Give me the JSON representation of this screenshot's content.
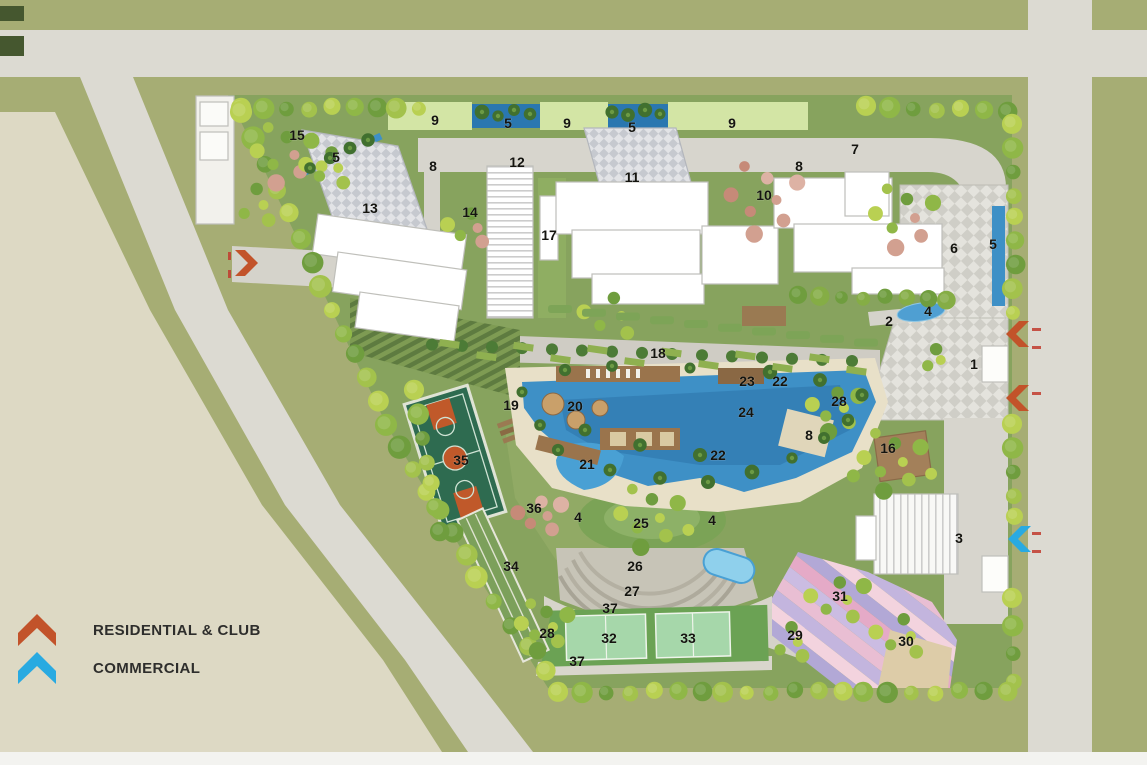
{
  "legend": {
    "items": [
      {
        "id": "residential",
        "label": "RESIDENTIAL & CLUB",
        "color": "#c2532a"
      },
      {
        "id": "commercial",
        "label": "COMMERCIAL",
        "color": "#29aae1"
      }
    ]
  },
  "colors": {
    "residential": "#c2532a",
    "commercial": "#29aae1",
    "pool_water": "#3e90c6",
    "site_lawn": "#87a35e",
    "road": "#dcdad2",
    "verge": "#a6ad74",
    "open_parcel": "#ddd9c4"
  },
  "markers": [
    {
      "n": "1",
      "x": 974,
      "y": 364
    },
    {
      "n": "2",
      "x": 889,
      "y": 321
    },
    {
      "n": "3",
      "x": 959,
      "y": 538
    },
    {
      "n": "4",
      "x": 928,
      "y": 311
    },
    {
      "n": "4",
      "x": 578,
      "y": 517
    },
    {
      "n": "4",
      "x": 712,
      "y": 520
    },
    {
      "n": "5",
      "x": 336,
      "y": 157
    },
    {
      "n": "5",
      "x": 508,
      "y": 123
    },
    {
      "n": "5",
      "x": 632,
      "y": 127
    },
    {
      "n": "5",
      "x": 993,
      "y": 244
    },
    {
      "n": "6",
      "x": 954,
      "y": 248
    },
    {
      "n": "7",
      "x": 855,
      "y": 149
    },
    {
      "n": "8",
      "x": 433,
      "y": 166
    },
    {
      "n": "8",
      "x": 799,
      "y": 166
    },
    {
      "n": "8",
      "x": 809,
      "y": 435
    },
    {
      "n": "9",
      "x": 435,
      "y": 120
    },
    {
      "n": "9",
      "x": 567,
      "y": 123
    },
    {
      "n": "9",
      "x": 732,
      "y": 123
    },
    {
      "n": "10",
      "x": 764,
      "y": 195
    },
    {
      "n": "11",
      "x": 632,
      "y": 177
    },
    {
      "n": "12",
      "x": 517,
      "y": 162
    },
    {
      "n": "13",
      "x": 370,
      "y": 208
    },
    {
      "n": "14",
      "x": 470,
      "y": 212
    },
    {
      "n": "15",
      "x": 297,
      "y": 135
    },
    {
      "n": "16",
      "x": 888,
      "y": 448
    },
    {
      "n": "17",
      "x": 549,
      "y": 235
    },
    {
      "n": "18",
      "x": 658,
      "y": 353
    },
    {
      "n": "19",
      "x": 511,
      "y": 405
    },
    {
      "n": "20",
      "x": 575,
      "y": 406
    },
    {
      "n": "21",
      "x": 587,
      "y": 464
    },
    {
      "n": "22",
      "x": 718,
      "y": 455
    },
    {
      "n": "22",
      "x": 780,
      "y": 381
    },
    {
      "n": "23",
      "x": 747,
      "y": 381
    },
    {
      "n": "24",
      "x": 746,
      "y": 412
    },
    {
      "n": "25",
      "x": 641,
      "y": 523
    },
    {
      "n": "26",
      "x": 635,
      "y": 566
    },
    {
      "n": "27",
      "x": 632,
      "y": 591
    },
    {
      "n": "28",
      "x": 547,
      "y": 633
    },
    {
      "n": "28",
      "x": 839,
      "y": 401
    },
    {
      "n": "29",
      "x": 795,
      "y": 635
    },
    {
      "n": "30",
      "x": 906,
      "y": 641
    },
    {
      "n": "31",
      "x": 840,
      "y": 596
    },
    {
      "n": "32",
      "x": 609,
      "y": 638
    },
    {
      "n": "33",
      "x": 688,
      "y": 638
    },
    {
      "n": "34",
      "x": 511,
      "y": 566
    },
    {
      "n": "35",
      "x": 461,
      "y": 460
    },
    {
      "n": "36",
      "x": 534,
      "y": 508
    },
    {
      "n": "37",
      "x": 610,
      "y": 608
    },
    {
      "n": "37",
      "x": 577,
      "y": 661
    }
  ],
  "entries": [
    {
      "kind": "residential",
      "dir": "right",
      "x": 247,
      "y": 263
    },
    {
      "kind": "residential",
      "dir": "left",
      "x": 1017,
      "y": 334
    },
    {
      "kind": "residential",
      "dir": "left",
      "x": 1017,
      "y": 398
    },
    {
      "kind": "commercial",
      "dir": "left",
      "x": 1019,
      "y": 539
    }
  ]
}
